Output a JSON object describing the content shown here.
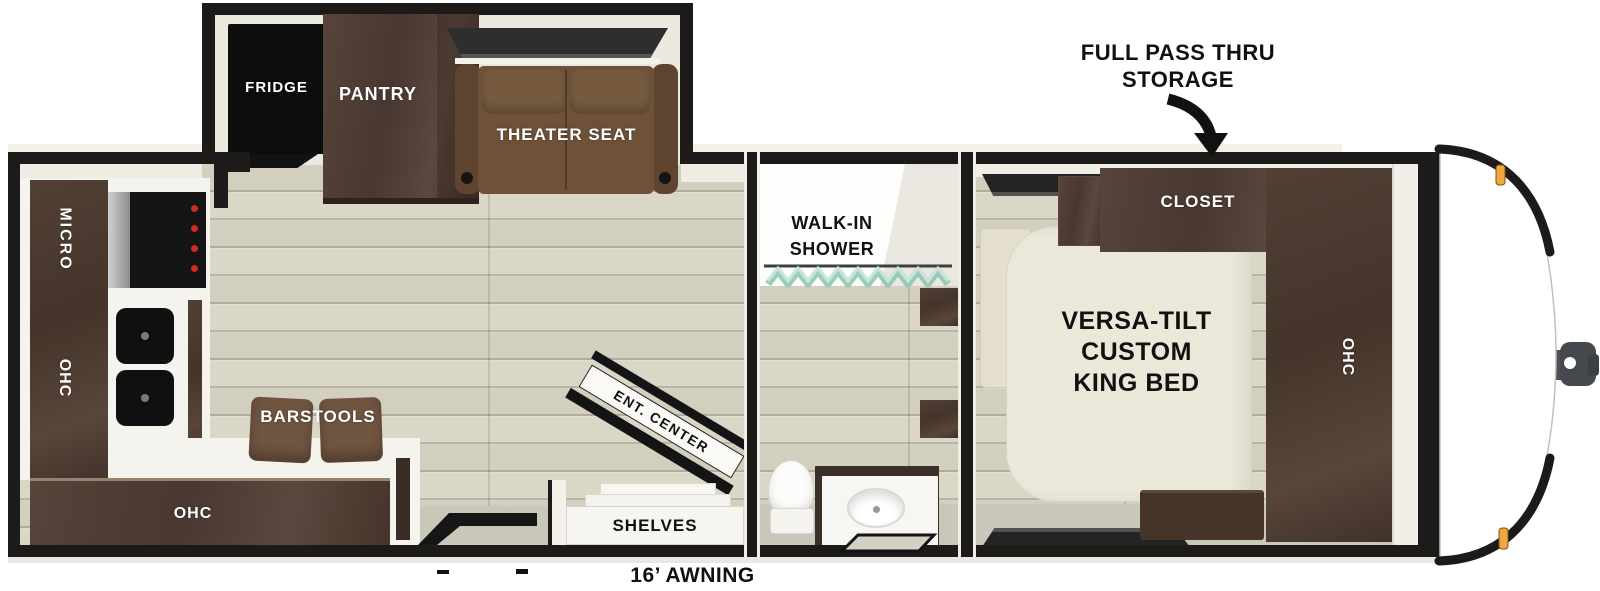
{
  "annotations": {
    "pass_thru_line1": "FULL PASS THRU",
    "pass_thru_line2": "STORAGE",
    "awning": "16’ AWNING"
  },
  "slideout": {
    "fridge": "FRIDGE",
    "pantry": "PANTRY",
    "theater_seat": "THEATER SEAT"
  },
  "kitchen": {
    "micro": "MICRO",
    "ohc_wall": "OHC",
    "ohc_lower": "OHC",
    "barstools": "BARSTOOLS"
  },
  "living": {
    "ent_center": "ENT. CENTER",
    "shelves": "SHELVES"
  },
  "bathroom": {
    "shower_line1": "WALK-IN",
    "shower_line2": "SHOWER"
  },
  "bedroom": {
    "closet": "CLOSET",
    "bed_line1": "VERSA-TILT",
    "bed_line2": "CUSTOM",
    "bed_line3": "KING BED",
    "ohc": "OHC"
  },
  "colors": {
    "wall": "#1d1b19",
    "floor": "#d9d5c4",
    "cabinet_dark_brown": "#4c3a30",
    "sofa_brown": "#6d5138",
    "bed_cream": "#ebe8d9",
    "counter_white": "#f4f3ee",
    "curtain_teal": "#8fc7b2",
    "marker_light_amber": "#f0a73e",
    "stove_knob_red": "#cf2b20"
  }
}
